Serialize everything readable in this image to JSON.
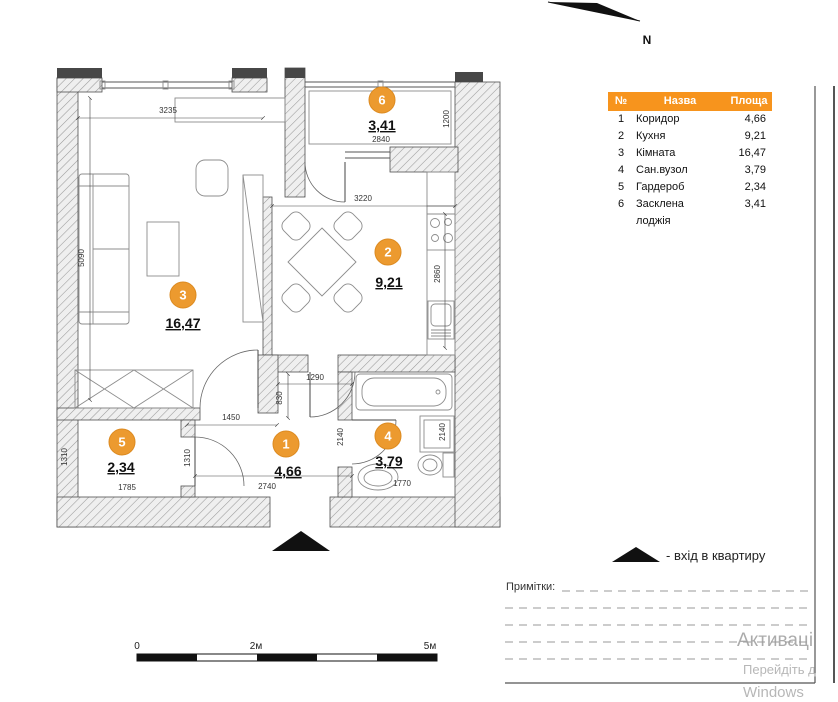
{
  "title_table": {
    "headers": [
      "№",
      "Назва",
      "Площа"
    ]
  },
  "rooms": [
    {
      "num": "1",
      "name": "Коридор",
      "area": "4,66"
    },
    {
      "num": "2",
      "name": "Кухня",
      "area": "9,21"
    },
    {
      "num": "3",
      "name": "Кімната",
      "area": "16,47"
    },
    {
      "num": "4",
      "name": "Сан.вузол",
      "area": "3,79"
    },
    {
      "num": "5",
      "name": "Гардероб",
      "area": "2,34"
    },
    {
      "num": "6",
      "name": "Засклена лоджія",
      "area": "3,41"
    }
  ],
  "dims": {
    "room3_top": "3235",
    "room3_left": "5090",
    "kitchen_top": "3220",
    "kitchen_right": "2860",
    "loggia_width": "2840",
    "loggia_depth": "1200",
    "corridor_top": "1290",
    "corridor_duct": "830",
    "corridor_mid": "1450",
    "corridor_bottom": "2740",
    "corridor_right": "2140",
    "bath_right": "2140",
    "bath_bottom": "1770",
    "wardrobe_bottom": "1785",
    "wardrobe_left": "1310",
    "wardrobe_right": "1310"
  },
  "north_label": "N",
  "scale_bar": {
    "start": "0",
    "middle": "2м",
    "end": "5м"
  },
  "entrance_label": "-  вхід в квартиру",
  "notes_label": "Примітки:",
  "watermark": {
    "line1": "Активаці",
    "line2": "Перейдіть д",
    "line3": "Windows"
  },
  "colors": {
    "accent_orange": "#F7941D",
    "badge_orange": "#EC9A2F",
    "wall_dark": "#474747"
  }
}
